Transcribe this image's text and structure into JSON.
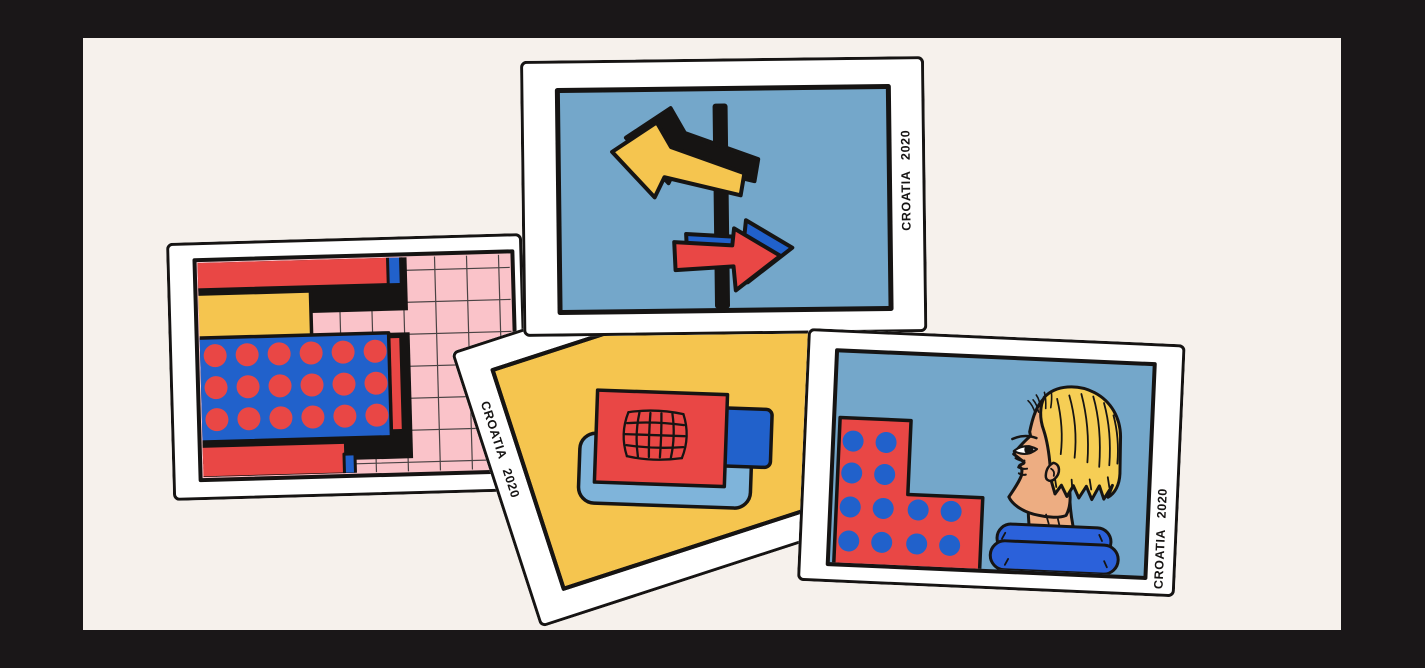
{
  "colors": {
    "frame": "#1A1718",
    "bg": "#F6F1EC",
    "white": "#FFFFFF",
    "ink": "#161413",
    "sky": "#74A7CA",
    "yellow": "#F5C54F",
    "red": "#E94745",
    "blue": "#2161CB",
    "pink": "#FAC3C9",
    "grid": "#4A4344",
    "ltblue": "#7FB4DA",
    "skin": "#EDAD82",
    "scarf": "#2B61DA",
    "hair": "#F6CE55"
  },
  "cards": [
    {
      "id": "signpost",
      "label": "CROATIA 2020",
      "subject": "Two-way signpost: yellow arrow pointing left, red arrow pointing right, blue sky"
    },
    {
      "id": "buildings",
      "label": "",
      "subject": "Abstract red, yellow and blue blocks with polka dots on a pink tiled grid"
    },
    {
      "id": "map",
      "label": "CROATIA 2020",
      "subject": "Red map card with sketched net grid on a light blue tray over yellow"
    },
    {
      "id": "portrait",
      "label": "CROATIA 2020",
      "subject": "Blonde traveller in profile with blue scarf beside a red polka-dot building"
    }
  ]
}
